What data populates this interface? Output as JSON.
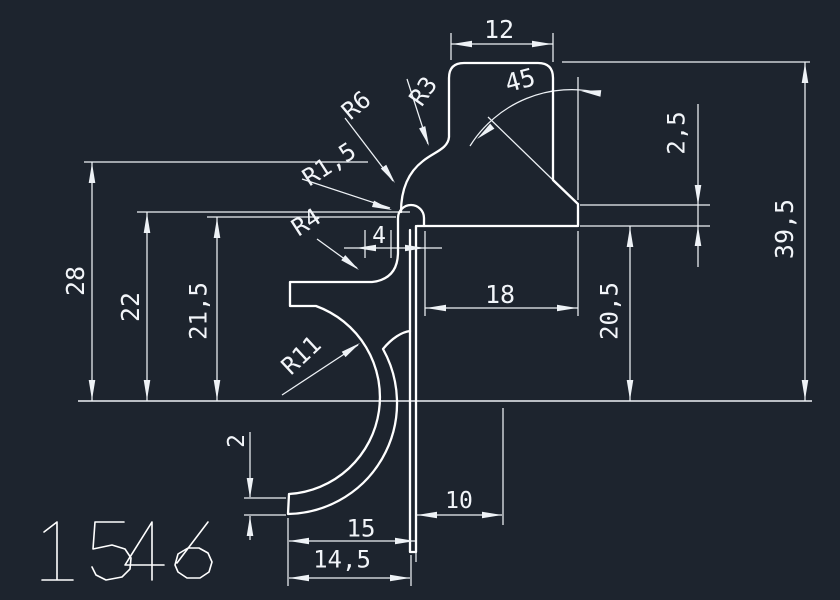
{
  "meta": {
    "app": "cad-drawing",
    "part_number": "1546"
  },
  "colors": {
    "background": "#1d242e",
    "dim_line": "#eef2f6",
    "part_line": "#ffffff",
    "text": "#f2f5f9"
  },
  "drawing": {
    "part_number": "1546",
    "profile_paths": [
      "M 401 212 C 401 193 406 174 423 161 C 434 152 448 149 449 137 L 449 78 Q 449 63 464 63 L 538 63 Q 553 63 553 78 L 553 180 L 578 204 L 578 226 L 417 226",
      "M 424 226 L 424 218 A 13 13 0 1 0 398 218 L 398 252 Q 398 279 372 282 L 290 282 L 290 306 L 316 306 A 97 97 0 0 1 289 494 L 288 514 A 111 111 0 0 0 383 349 C 392 338 402 332 410 331",
      "M 410 230 L 410 552 L 416 552 L 416 226"
    ],
    "baseline": [
      78,
      401,
      812,
      401
    ],
    "ext_lines": [
      [
        451,
        33,
        451,
        60
      ],
      [
        553,
        33,
        553,
        62
      ],
      [
        562,
        62,
        810,
        62
      ],
      [
        84,
        162,
        368,
        162
      ],
      [
        137,
        212,
        410,
        212
      ],
      [
        207,
        217,
        396,
        217
      ],
      [
        580,
        205,
        710,
        205
      ],
      [
        580,
        226,
        710,
        226
      ],
      [
        425,
        231,
        425,
        316
      ],
      [
        578,
        231,
        578,
        316
      ],
      [
        578,
        77,
        578,
        200
      ],
      [
        488,
        117,
        553,
        180
      ],
      [
        503,
        408,
        503,
        525
      ],
      [
        288,
        518,
        288,
        586
      ],
      [
        411,
        555,
        411,
        586
      ],
      [
        416,
        552,
        416,
        562
      ],
      [
        244,
        498,
        286,
        498
      ],
      [
        244,
        515,
        286,
        515
      ],
      [
        391,
        230,
        391,
        258
      ],
      [
        365,
        230,
        365,
        258
      ]
    ],
    "dim_lines": [
      [
        451,
        44,
        553,
        44
      ],
      [
        805,
        62,
        805,
        401
      ],
      [
        92,
        162,
        92,
        401
      ],
      [
        147,
        212,
        147,
        401
      ],
      [
        217,
        217,
        217,
        401
      ],
      [
        630,
        226,
        630,
        401
      ],
      [
        698,
        104,
        698,
        267
      ],
      [
        425,
        308,
        578,
        308
      ],
      [
        344,
        248,
        442,
        248
      ],
      [
        417,
        515,
        502,
        515
      ],
      [
        289,
        541,
        415,
        541
      ],
      [
        289,
        578,
        410,
        578
      ],
      [
        250,
        432,
        250,
        497
      ],
      [
        250,
        516,
        250,
        540
      ]
    ],
    "leader_lines": [
      [
        407,
        79,
        428,
        144
      ],
      [
        345,
        118,
        393,
        181
      ],
      [
        302,
        179,
        390,
        208
      ],
      [
        317,
        239,
        357,
        268
      ],
      [
        282,
        395,
        358,
        345
      ]
    ],
    "arc_paths": [
      "M 470 146 A 120 120 0 0 1 600 93"
    ],
    "arrows": [
      {
        "x": 452,
        "y": 44,
        "a": 180
      },
      {
        "x": 552,
        "y": 44,
        "a": 0
      },
      {
        "x": 805,
        "y": 63,
        "a": -90
      },
      {
        "x": 805,
        "y": 400,
        "a": 90
      },
      {
        "x": 92,
        "y": 163,
        "a": -90
      },
      {
        "x": 92,
        "y": 400,
        "a": 90
      },
      {
        "x": 147,
        "y": 213,
        "a": -90
      },
      {
        "x": 147,
        "y": 400,
        "a": 90
      },
      {
        "x": 217,
        "y": 218,
        "a": -90
      },
      {
        "x": 217,
        "y": 400,
        "a": 90
      },
      {
        "x": 630,
        "y": 227,
        "a": -90
      },
      {
        "x": 630,
        "y": 400,
        "a": 90
      },
      {
        "x": 698,
        "y": 205,
        "a": 90
      },
      {
        "x": 698,
        "y": 226,
        "a": -90
      },
      {
        "x": 426,
        "y": 308,
        "a": 180
      },
      {
        "x": 577,
        "y": 308,
        "a": 0
      },
      {
        "x": 356,
        "y": 248,
        "a": 180
      },
      {
        "x": 425,
        "y": 248,
        "a": 0
      },
      {
        "x": 417,
        "y": 515,
        "a": 180
      },
      {
        "x": 502,
        "y": 515,
        "a": 0
      },
      {
        "x": 289,
        "y": 541,
        "a": 180
      },
      {
        "x": 415,
        "y": 541,
        "a": 0
      },
      {
        "x": 289,
        "y": 578,
        "a": 180
      },
      {
        "x": 410,
        "y": 578,
        "a": 0
      },
      {
        "x": 250,
        "y": 498,
        "a": 90
      },
      {
        "x": 250,
        "y": 516,
        "a": -90
      },
      {
        "x": 477,
        "y": 139,
        "a": 140
      },
      {
        "x": 581,
        "y": 91,
        "a": 187
      },
      {
        "x": 429,
        "y": 146,
        "a": 70
      },
      {
        "x": 395,
        "y": 183,
        "a": 55
      },
      {
        "x": 392,
        "y": 210,
        "a": 18
      },
      {
        "x": 359,
        "y": 270,
        "a": 38
      },
      {
        "x": 360,
        "y": 343,
        "a": -35
      }
    ],
    "labels": [
      {
        "t": "12",
        "x": 499,
        "y": 29,
        "r": 0,
        "s": 25
      },
      {
        "t": "45",
        "x": 520,
        "y": 80,
        "r": -15,
        "s": 25
      },
      {
        "t": "R3",
        "x": 423,
        "y": 91,
        "r": -55,
        "s": 24
      },
      {
        "t": "R6",
        "x": 356,
        "y": 105,
        "r": -40,
        "s": 24
      },
      {
        "t": "R1,5",
        "x": 329,
        "y": 164,
        "r": -33,
        "s": 24
      },
      {
        "t": "R4",
        "x": 306,
        "y": 222,
        "r": -33,
        "s": 24
      },
      {
        "t": "4",
        "x": 379,
        "y": 235,
        "r": 0,
        "s": 23
      },
      {
        "t": "2,5",
        "x": 676,
        "y": 133,
        "r": -90,
        "s": 24
      },
      {
        "t": "39,5",
        "x": 784,
        "y": 229,
        "r": -90,
        "s": 25
      },
      {
        "t": "28",
        "x": 75,
        "y": 281,
        "r": -90,
        "s": 25
      },
      {
        "t": "22",
        "x": 130,
        "y": 307,
        "r": -90,
        "s": 25
      },
      {
        "t": "21,5",
        "x": 198,
        "y": 311,
        "r": -90,
        "s": 24
      },
      {
        "t": "20,5",
        "x": 609,
        "y": 311,
        "r": -90,
        "s": 24
      },
      {
        "t": "18",
        "x": 500,
        "y": 294,
        "r": 0,
        "s": 25
      },
      {
        "t": "10",
        "x": 459,
        "y": 500,
        "r": 0,
        "s": 23
      },
      {
        "t": "15",
        "x": 361,
        "y": 528,
        "r": 0,
        "s": 24
      },
      {
        "t": "14,5",
        "x": 342,
        "y": 559,
        "r": 0,
        "s": 24
      },
      {
        "t": "2",
        "x": 236,
        "y": 441,
        "r": -90,
        "s": 23
      },
      {
        "t": "R11",
        "x": 301,
        "y": 355,
        "r": -43,
        "s": 24
      }
    ],
    "part_number_paths": [
      "M 44 532 L 57 522 L 57 580 M 42 580 L 73 580",
      "M 124 522 L 95 522 L 93 549 L 112 545 L 125 549 L 131 558 L 130 569 L 122 577 L 106 580 L 96 575 L 92 567",
      "M 152 522 L 125 565 L 164 565 M 152 522 L 152 580",
      "M 208 522 L 186 551 L 177 563 M 175 565 L 178 554 L 188 548 L 199 548 L 208 553 L 212 562 L 209 572 L 200 578 L 187 578 L 178 572 L 175 565"
    ]
  }
}
